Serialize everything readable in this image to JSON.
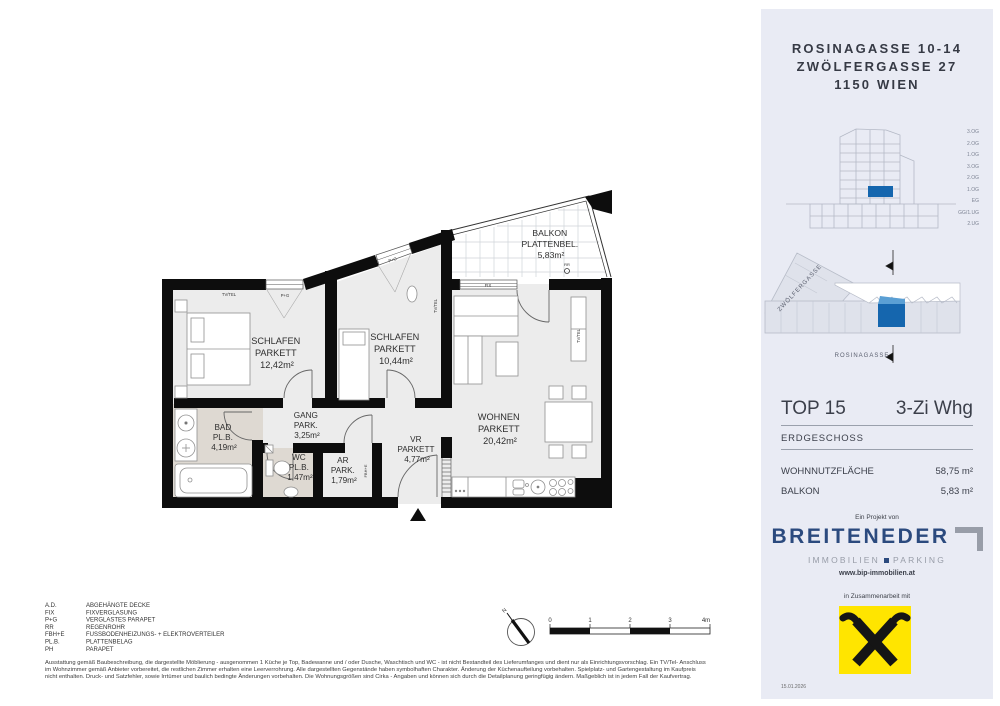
{
  "plan": {
    "rooms": [
      {
        "name": "SCHLAFEN",
        "finish": "PARKETT",
        "area": "12,42m²"
      },
      {
        "name": "SCHLAFEN",
        "finish": "PARKETT",
        "area": "10,44m²"
      },
      {
        "name": "WOHNEN",
        "finish": "PARKETT",
        "area": "20,42m²"
      },
      {
        "name": "GANG",
        "finish": "PARK.",
        "area": "3,25m²"
      },
      {
        "name": "BAD",
        "finish": "PL.B.",
        "area": "4,19m²"
      },
      {
        "name": "WC",
        "finish": "PL.B.",
        "area": "1,47m²"
      },
      {
        "name": "AR",
        "finish": "PARK.",
        "area": "1,79m²"
      },
      {
        "name": "VR",
        "finish": "PARKETT",
        "area": "4,77m²"
      },
      {
        "name": "BALKON",
        "finish": "PLATTENBEL.",
        "area": "5,83m²"
      }
    ],
    "annotations": {
      "tv_tel": "TV/TEL",
      "p_g": "P+G",
      "fix": "FIX",
      "rr": "RR",
      "fbh_e": "FBH+E"
    },
    "north": "N",
    "scalebar": {
      "labels": [
        "0",
        "1",
        "2",
        "3",
        "4m"
      ]
    },
    "legend": {
      "items": [
        {
          "abbr": "A.D.",
          "label": "ABGEHÄNGTE DECKE"
        },
        {
          "abbr": "FIX",
          "label": "FIXVERGLASUNG"
        },
        {
          "abbr": "P+G",
          "label": "VERGLASTES PARAPET"
        },
        {
          "abbr": "RR",
          "label": "REGENROHR"
        },
        {
          "abbr": "FBH+E",
          "label": "FUSSBODENHEIZUNGS- + ELEKTROVERTEILER"
        },
        {
          "abbr": "PL.B.",
          "label": "PLATTENBELAG"
        },
        {
          "abbr": "PH",
          "label": "PARAPET"
        }
      ]
    },
    "disclaimer_lines": [
      "Ausstattung gemäß Baubeschreibung, die dargestellte Möblierung - ausgenommen 1 Küche je Top, Badewanne und / oder Dusche, Waschtisch und WC - ist nicht Bestandteil des Lieferumfanges und dient nur als Einrichtungsvorschlag. Ein TV/Tel- Anschluss",
      "im Wohnzimmer gemäß Anbieter vorbereitet, die restlichen Zimmer erhalten eine Leerverrohrung. Alle dargestellten Gegenstände haben symbolhaften Charakter. Änderung der Küchenaufteilung vorbehalten. Spielplatz- und Gartengestaltung im Kaufpreis",
      "nicht enthalten. Druck- und Satzfehler, sowie Irrtümer und baulich bedingte Änderungen vorbehalten. Die Wohnungsgrößen sind Cirka - Angaben und können sich durch die Detailplanung geringfügig ändern. Maßgeblich ist in jedem Fall der Kaufvertrag."
    ]
  },
  "sidebar": {
    "address_lines": [
      "ROSINAGASSE 10-14",
      "ZWÖLFERGASSE 27",
      "1150 WIEN"
    ],
    "section_floor_labels": [
      "3.OG",
      "2.OG",
      "1.OG",
      "3.OG",
      "2.OG",
      "1.OG",
      "EG",
      "GG/1.UG",
      "2.UG"
    ],
    "site": {
      "street_top": "ZWÖLFERGASSE",
      "street_bottom": "ROSINAGASSE"
    },
    "unit": {
      "top": "TOP 15",
      "type": "3-Zi Whg",
      "floor": "ERDGESCHOSS",
      "metric1_label": "WOHNNUTZFLÄCHE",
      "metric1_value": "58,75 m²",
      "metric2_label": "BALKON",
      "metric2_value": "5,83 m²"
    },
    "branding": {
      "project_by": "Ein Projekt von",
      "brand": "BREITENEDER",
      "sub_left": "IMMOBILIEN",
      "sub_right": "PARKING",
      "website": "www.bip-immobilien.at",
      "cooperation": "in Zusammenarbeit mit"
    },
    "date": "15.01.2026",
    "colors": {
      "accent_blue": "#1566ae",
      "brand_navy": "#2b4a7e",
      "raiffeisen_yellow": "#ffe500",
      "sidebar_bg": "#e9ebf4"
    }
  }
}
